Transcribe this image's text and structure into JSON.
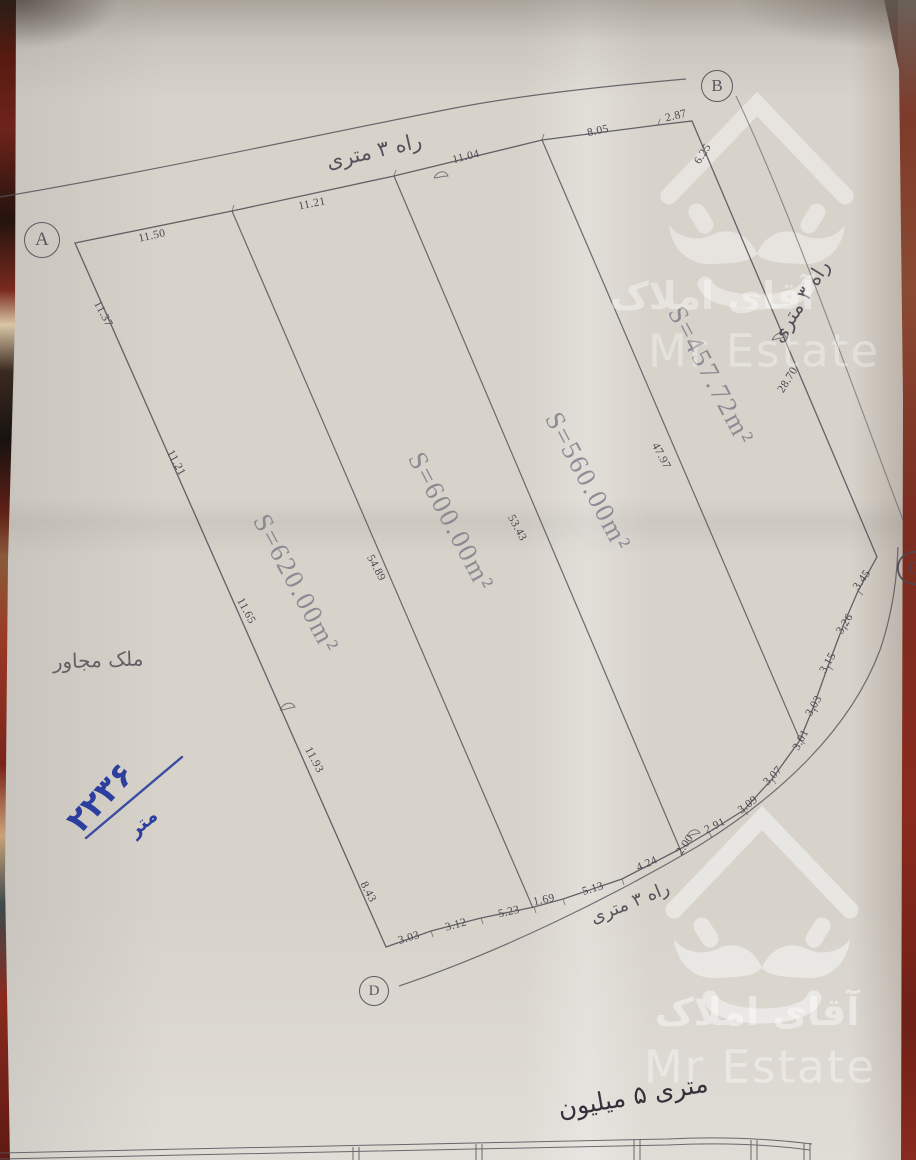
{
  "colors": {
    "pencil": "#56535b",
    "pen_black": "#33313a",
    "pen_blue": "#2c3e9e",
    "paper": "#d7d3cb",
    "carpet_red": "#8a2a1e",
    "watermark": "#ffffff"
  },
  "watermark": {
    "brand_fa": "آقای املاک",
    "brand_en": "Mr Estate"
  },
  "markers": [
    {
      "letter": "A",
      "x": 42,
      "y": 240,
      "d": 34
    },
    {
      "letter": "B",
      "x": 717,
      "y": 86,
      "d": 30
    },
    {
      "letter": "C",
      "x": 914,
      "y": 568,
      "d": 32
    },
    {
      "letter": "D",
      "x": 374,
      "y": 991,
      "d": 28
    }
  ],
  "road_labels": [
    {
      "t": "راه ۳ متری",
      "x": 374,
      "y": 151,
      "r": -13,
      "s": 21,
      "n": "road-label-top"
    },
    {
      "t": "راه ۳ متری",
      "x": 800,
      "y": 301,
      "r": -58,
      "s": 20,
      "n": "road-label-right"
    },
    {
      "t": "راه ۳ متری",
      "x": 630,
      "y": 903,
      "r": -22,
      "s": 18,
      "n": "road-label-bottom"
    }
  ],
  "plot_areas": [
    {
      "t": "S=620.00m²",
      "x": 296,
      "y": 584,
      "r": 62,
      "n": "plot-area-620"
    },
    {
      "t": "S=600.00m²",
      "x": 451,
      "y": 522,
      "r": 62,
      "n": "plot-area-600"
    },
    {
      "t": "S=560.00m²",
      "x": 588,
      "y": 482,
      "r": 62,
      "n": "plot-area-560"
    },
    {
      "t": "S=457.72m²",
      "x": 711,
      "y": 376,
      "r": 62,
      "n": "plot-area-457"
    }
  ],
  "dimensions": [
    {
      "t": "11.50",
      "x": 152,
      "y": 236,
      "r": -12
    },
    {
      "t": "11.21",
      "x": 312,
      "y": 204,
      "r": -11
    },
    {
      "t": "11.04",
      "x": 466,
      "y": 157,
      "r": -14
    },
    {
      "t": "8.05",
      "x": 598,
      "y": 131,
      "r": -12
    },
    {
      "t": "2.87",
      "x": 676,
      "y": 116,
      "r": -14
    },
    {
      "t": "6.25",
      "x": 703,
      "y": 154,
      "r": -58
    },
    {
      "t": "28.70",
      "x": 788,
      "y": 380,
      "r": -58
    },
    {
      "t": "11.37",
      "x": 103,
      "y": 314,
      "r": 62
    },
    {
      "t": "11.21",
      "x": 176,
      "y": 463,
      "r": 62
    },
    {
      "t": "11.65",
      "x": 246,
      "y": 611,
      "r": 62
    },
    {
      "t": "11.93",
      "x": 314,
      "y": 760,
      "r": 62
    },
    {
      "t": "8.43",
      "x": 368,
      "y": 892,
      "r": 62
    },
    {
      "t": "54.89",
      "x": 376,
      "y": 568,
      "r": 62
    },
    {
      "t": "53.43",
      "x": 517,
      "y": 528,
      "r": 62
    },
    {
      "t": "47.97",
      "x": 661,
      "y": 456,
      "r": 62
    },
    {
      "t": "3.03",
      "x": 409,
      "y": 938,
      "r": -17
    },
    {
      "t": "3.12",
      "x": 456,
      "y": 925,
      "r": -15
    },
    {
      "t": "5.23",
      "x": 509,
      "y": 912,
      "r": -13
    },
    {
      "t": "1.69",
      "x": 544,
      "y": 900,
      "r": -12
    },
    {
      "t": "5.13",
      "x": 593,
      "y": 889,
      "r": -17
    },
    {
      "t": "4.24",
      "x": 647,
      "y": 864,
      "r": -24
    },
    {
      "t": "2.00",
      "x": 685,
      "y": 845,
      "r": -55
    },
    {
      "t": "2.91",
      "x": 715,
      "y": 826,
      "r": -26
    },
    {
      "t": "3.09",
      "x": 748,
      "y": 805,
      "r": -38
    },
    {
      "t": "3.07",
      "x": 773,
      "y": 776,
      "r": -46
    },
    {
      "t": "3.01",
      "x": 801,
      "y": 740,
      "r": -62
    },
    {
      "t": "3.03",
      "x": 814,
      "y": 706,
      "r": -60
    },
    {
      "t": "3.15",
      "x": 828,
      "y": 663,
      "r": -60
    },
    {
      "t": "3.26",
      "x": 845,
      "y": 624,
      "r": -58
    },
    {
      "t": "3.45",
      "x": 862,
      "y": 580,
      "r": -54
    }
  ],
  "handwriting": {
    "adjacent_property": "ملک مجاور",
    "blue_total": "۲۲۳۶",
    "blue_unit": "متر",
    "price_note": "متری ۵ میلیون"
  }
}
